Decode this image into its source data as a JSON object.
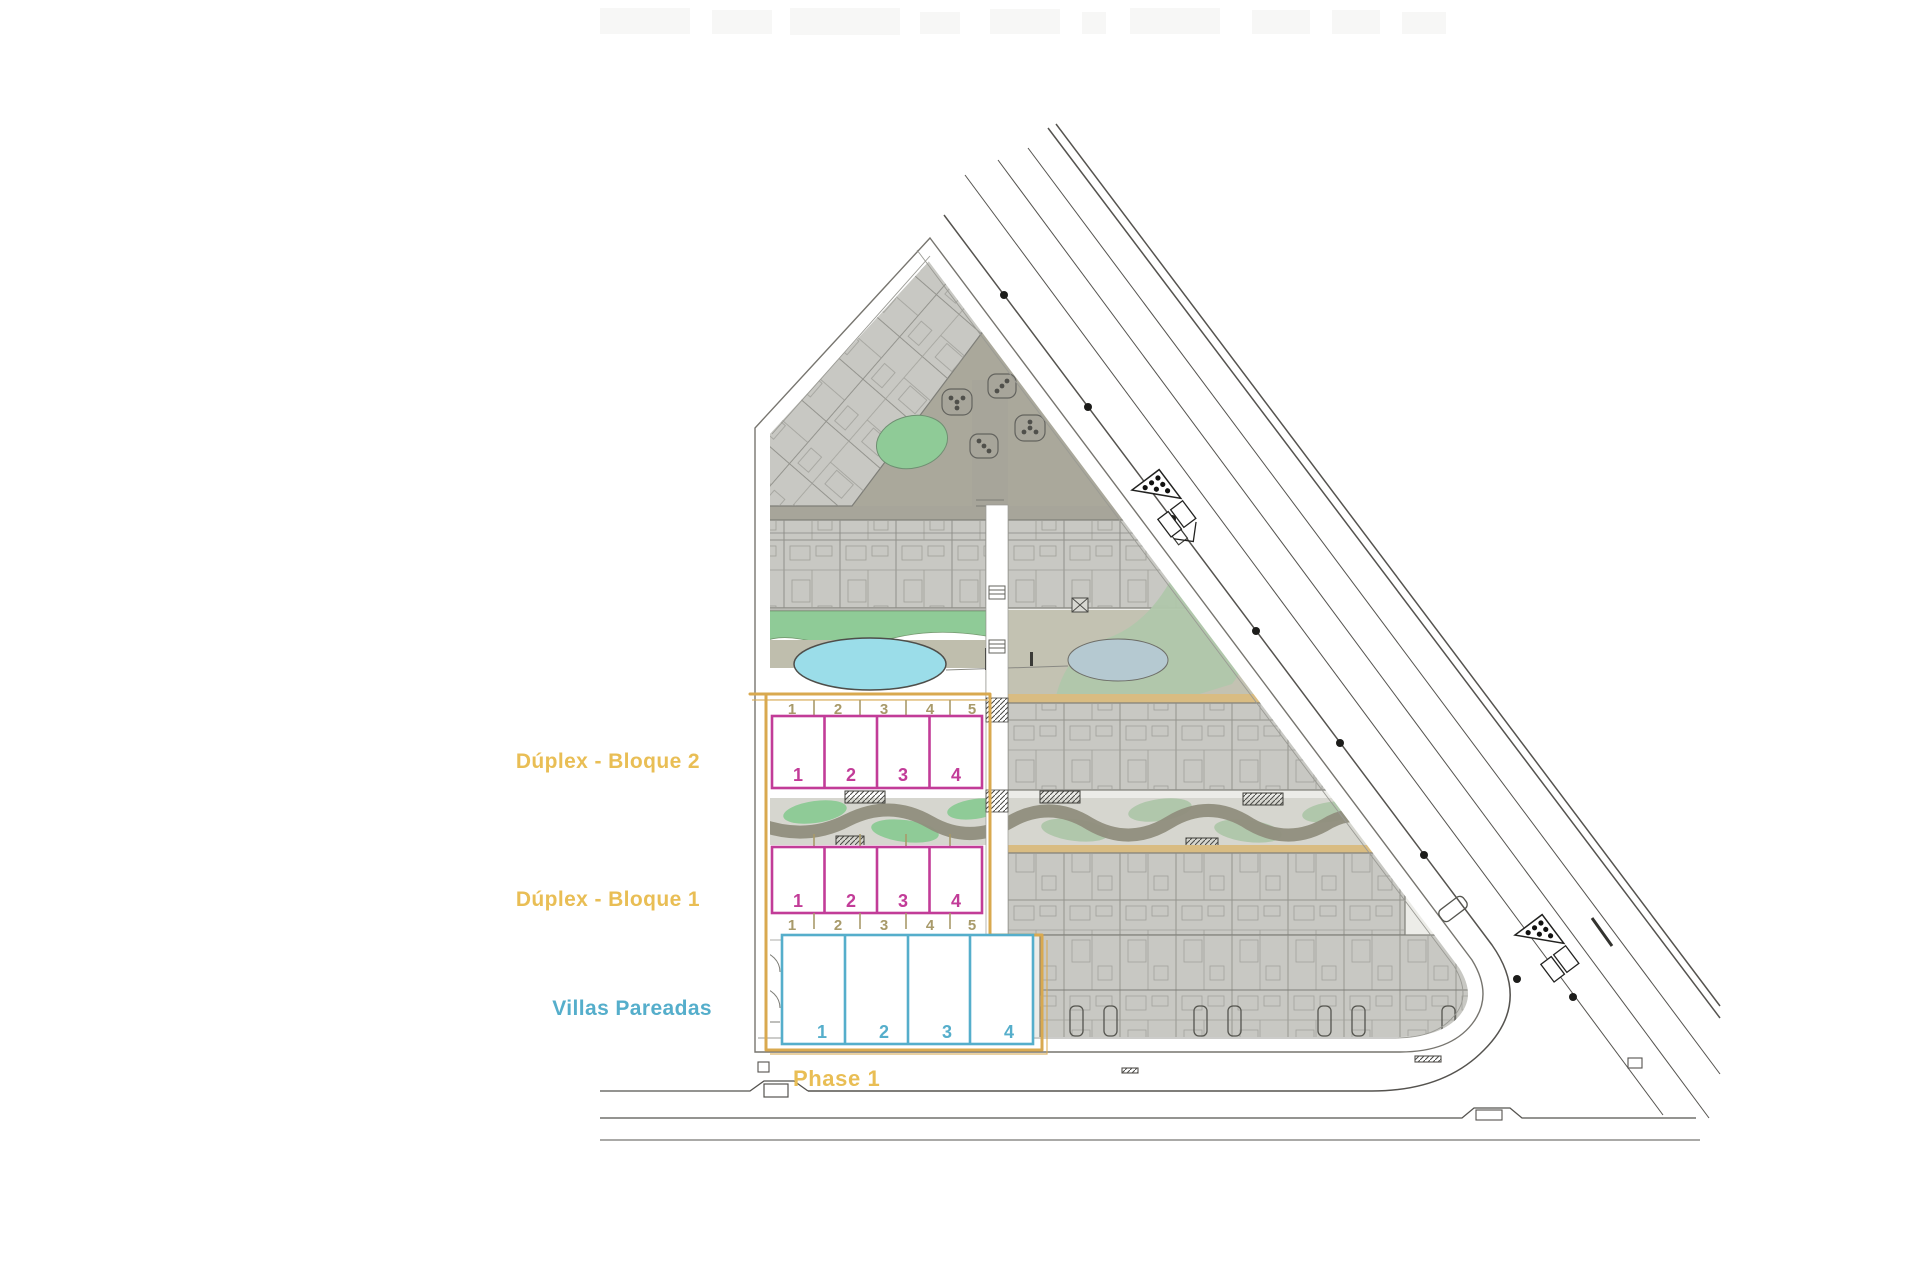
{
  "labels": {
    "bloque2": "Dúplex - Bloque 2",
    "bloque1": "Dúplex - Bloque 1",
    "villas": "Villas Pareadas",
    "phase": "Phase 1"
  },
  "plan": {
    "bloque2": {
      "plot_numbers": [
        "1",
        "2",
        "3",
        "4",
        "5"
      ],
      "unit_numbers": [
        "1",
        "2",
        "3",
        "4"
      ]
    },
    "bloque1": {
      "unit_numbers": [
        "1",
        "2",
        "3",
        "4"
      ],
      "plot_numbers": [
        "1",
        "2",
        "3",
        "4",
        "5"
      ]
    },
    "villas": {
      "unit_numbers": [
        "1",
        "2",
        "3",
        "4"
      ]
    }
  },
  "colors": {
    "label_gold": "#E9BE55",
    "boundary_gold": "#D9A94F",
    "tan": "#A89A6A",
    "pink": "#C23C98",
    "blue": "#55AECB",
    "pool": "#9BDDE9",
    "pond": "#B5C9D1",
    "green": "#8FCB97",
    "green_muted": "#B0C7AB",
    "olive": "#908E7D"
  }
}
